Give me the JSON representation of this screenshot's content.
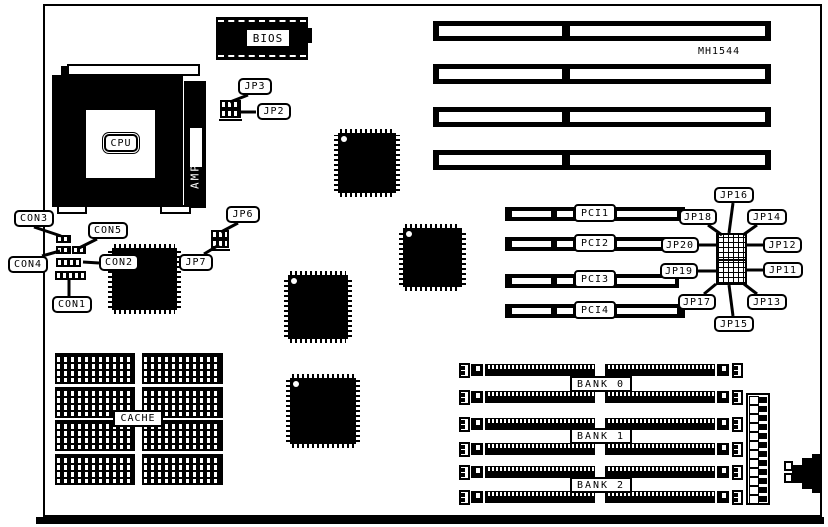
{
  "labels": {
    "model": "MH1544",
    "bios": "BIOS",
    "cpu": "CPU",
    "cpu_bracket": "AMP",
    "cache": "CACHE"
  },
  "connectors": {
    "con1": "CON1",
    "con2": "CON2",
    "con3": "CON3",
    "con4": "CON4",
    "con5": "CON5"
  },
  "jumpers": {
    "jp2": "JP2",
    "jp3": "JP3",
    "jp6": "JP6",
    "jp7": "JP7",
    "jp11": "JP11",
    "jp12": "JP12",
    "jp13": "JP13",
    "jp14": "JP14",
    "jp15": "JP15",
    "jp16": "JP16",
    "jp17": "JP17",
    "jp18": "JP18",
    "jp19": "JP19",
    "jp20": "JP20"
  },
  "pci_slots": {
    "pci1": "PCI1",
    "pci2": "PCI2",
    "pci3": "PCI3",
    "pci4": "PCI4"
  },
  "memory_banks": {
    "bank0": "BANK 0",
    "bank1": "BANK 1",
    "bank2": "BANK 2"
  },
  "colors": {
    "ink": "#000000",
    "paper": "#ffffff"
  }
}
